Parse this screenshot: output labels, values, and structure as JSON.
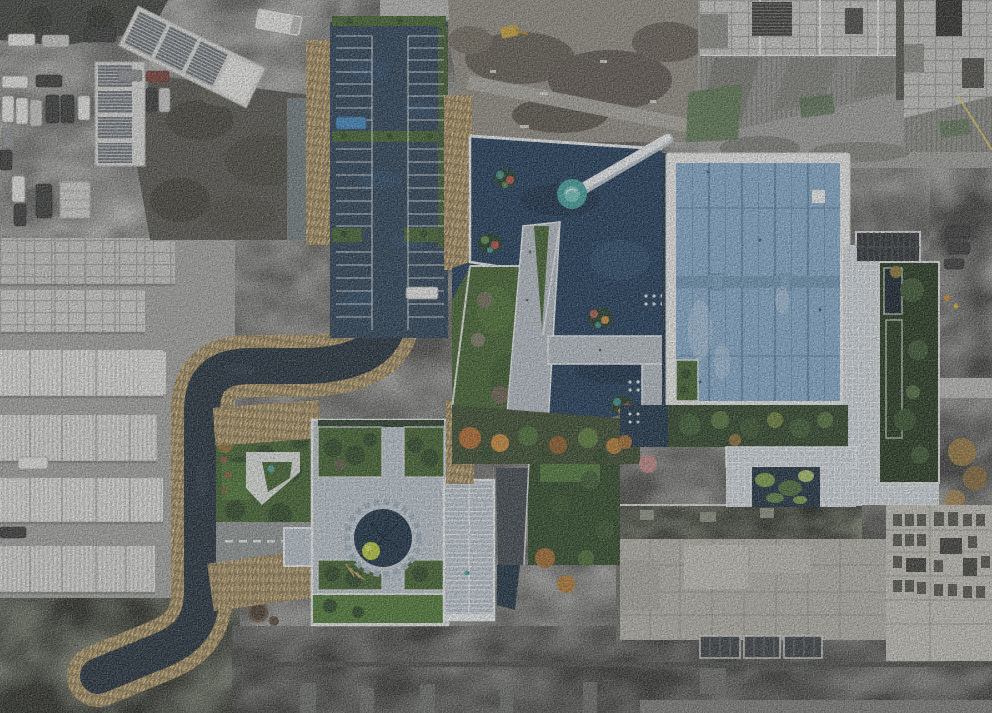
{
  "scene": {
    "type": "aerial-drone-photograph",
    "label": "Aerial top-down view of a modern building complex with a dark reflecting pond, glass grid roof hall, cross-shaped plaza with circular sunken courtyard, tree-lined parking court, golden reed hedges, warehouse rows and surrounding construction sites",
    "features": [
      "gray-car-park-northwest",
      "solar-roof-sheds",
      "dark-rubble-lot",
      "tree-lined-parking-court",
      "golden-reed-hedges",
      "s-curve-access-road",
      "warehouse-rows-west",
      "reflecting-pond",
      "floating-planted-islands",
      "white-footbridge",
      "turquoise-landing-pad",
      "zigzag-promenade",
      "triangular-lawn",
      "glass-grid-roof-hall",
      "white-perimeter-walkway",
      "sunken-green-courtyard-east",
      "solar-panel-array",
      "organic-pattern-garden",
      "sunken-circular-courtyard",
      "cross-shaped-plaza",
      "ribbed-glass-canopy",
      "west-sculpture-garden",
      "concrete-building-southeast",
      "highrise-construction-northeast",
      "boundary-wall-south",
      "autumn-tree-band"
    ]
  },
  "palette": {
    "water": "#1F3A58",
    "waterDeep": "#16293F",
    "waterLight": "#2E4E70",
    "asphalt": "#2B4156",
    "road": "#232F3B",
    "reedBase": "#8D7C58",
    "reedLight": "#C9A96E",
    "reedPale": "#E4CF9A",
    "grass": "#41612F",
    "grassDark": "#2E4827",
    "lawn": "#4E7936",
    "hedge": "#283C29",
    "autumn": "#B06A2E",
    "autumnLight": "#C8893A",
    "paving": "#B8C2CB",
    "pavingLight": "#CDD5DB",
    "whiteEdge": "#ECEFF0",
    "glass": "#84AACB",
    "mullion": "#5F88AB",
    "frame": "#E9EBE9",
    "concrete": "#B2B0A7",
    "concreteLight": "#C6C7C3",
    "concreteDark": "#8E8F8B",
    "gravel": "#A3A4A0",
    "gravelLight": "#BCBDB9",
    "gravelDark": "#7E7F7B",
    "rubble": "#55544E",
    "dirt": "#6B5F52",
    "teal": "#3F9E9B",
    "tealPale": "#7AC8C3",
    "shed": "#D6D7D3",
    "carWhite": "#E6E7E5",
    "carDark": "#3A3B3B",
    "carGray": "#8F9092",
    "carSilver": "#C6C7C5",
    "carRed": "#7A4038",
    "carBlue": "#3F86BD",
    "solar": "#2C3135",
    "deck": "#79806E",
    "bush": "#B5C93E",
    "pinkTree": "#BB8684"
  }
}
